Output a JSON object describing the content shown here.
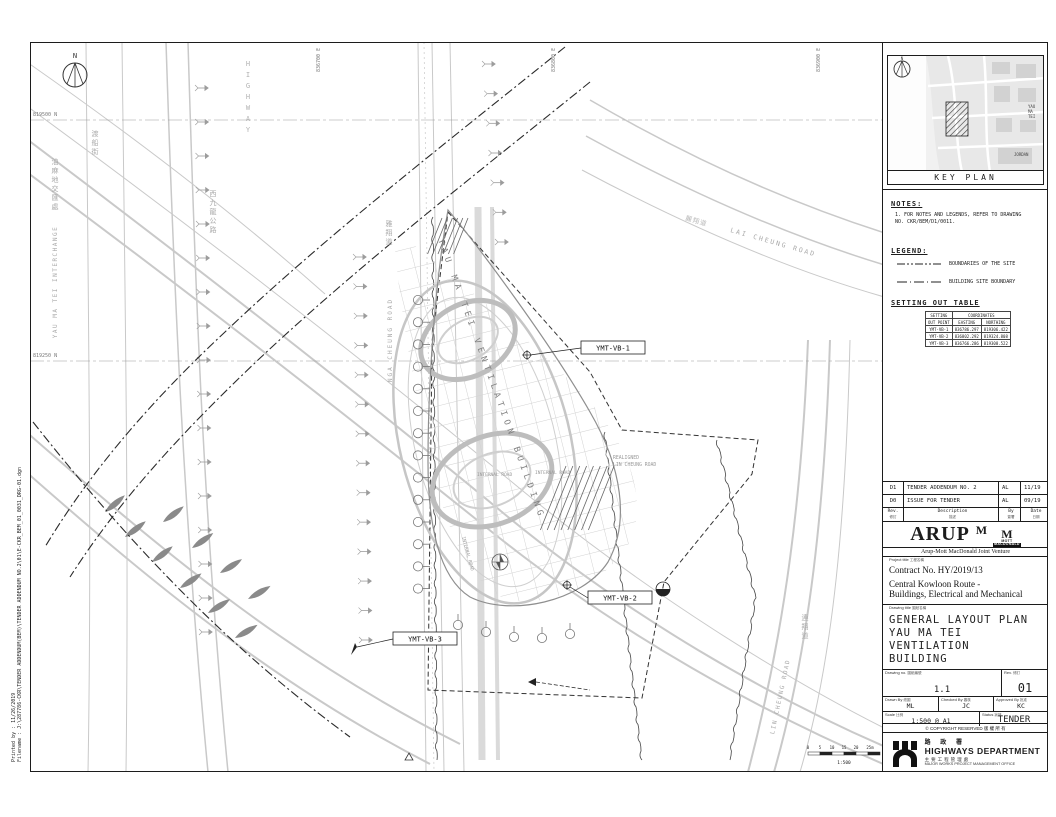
{
  "margin": {
    "printed_by": "Printed by : 11/26/2019",
    "filename": "Filename : J:\\287786-CKR\\TENDER ADDENDUM(BEM)\\TENDER ADDENDUM NO.2\\01\\E-CKR_BEM_01_0031_DRG-01.dgn"
  },
  "plan": {
    "north": "N",
    "grid": {
      "northing1": "819500 N",
      "northing2": "819250 N",
      "easting1": "836700 E",
      "easting2": "836800 E",
      "easting3": "836900 E"
    },
    "roads": {
      "interchange_en": "YAU MA TEI INTERCHANGE",
      "interchange_zh": "油麻地交匯處",
      "highway_en": "HIGHWAY",
      "ferry_street_zh": "渡船街",
      "west_kowloon_highway_zh": "西九龍公路",
      "nga_cheung_en": "NGA CHEUNG ROAD",
      "nga_cheung_zh": "雅翔道",
      "lai_cheung_en": "LAI CHEUNG ROAD",
      "lai_cheung_zh": "麗翔道",
      "lin_cheung_en": "LIN CHEUNG ROAD",
      "lin_cheung_zh": "連翔道",
      "realigned_line1": "REALIGNED",
      "realigned_line2": "LIN CHEUNG ROAD"
    },
    "building": {
      "label": "YAU MA TEI VENTILATION BUILDING",
      "internal_road": "INTERNAL ROAD"
    },
    "setting_out_points": {
      "p1": "YMT-VB-1",
      "p2": "YMT-VB-2",
      "p3": "YMT-VB-3"
    },
    "scalebar": {
      "ticks": [
        "0",
        "5",
        "10",
        "15",
        "20",
        "25m"
      ],
      "ratio": "1:500"
    }
  },
  "titleblock": {
    "keyplan": {
      "caption": "KEY PLAN",
      "north": "N",
      "ymt1": "YAU",
      "ymt2": "MA",
      "ymt3": "TEI",
      "jordan": "JORDAN"
    },
    "notes": {
      "heading": "NOTES:",
      "item": "1. FOR NOTES AND LEGENDS, REFER TO DRAWING NO. CKR/BEM/D1/0011."
    },
    "legend": {
      "heading": "LEGEND:",
      "boundary_site": "BOUNDARIES OF THE SITE",
      "building_site": "BUILDING SITE BOUNDARY"
    },
    "setting_out": {
      "heading": "SETTING OUT TABLE",
      "col_point1": "SETTING",
      "col_point2": "OUT POINT",
      "col_coords": "COORDINATES",
      "col_easting": "EASTING",
      "col_northing": "NORTHING",
      "rows": [
        [
          "YMT-VB-1",
          "836786.297",
          "819306.422"
        ],
        [
          "YMT-VB-2",
          "836802.292",
          "819324.808"
        ],
        [
          "YMT-VB-3",
          "836766.286",
          "819308.522"
        ]
      ]
    },
    "revisions": {
      "rows": [
        {
          "rev": "D1",
          "description": "TENDER ADDENDUM NO. 2",
          "by": "AL",
          "date": "11/19"
        },
        {
          "rev": "D0",
          "description": "ISSUE FOR TENDER",
          "by": "AL",
          "date": "09/19"
        }
      ],
      "header": {
        "rev_en": "Rev.",
        "rev_zh": "修訂",
        "desc_en": "Description",
        "desc_zh": "描述",
        "by_en": "By",
        "by_zh": "簽署",
        "date_en": "Date",
        "date_zh": "日期"
      }
    },
    "firm": {
      "arup": "ARUP",
      "m1": "M",
      "m2": "M",
      "mott": "MOTT",
      "macdonald": "MACDONALD",
      "jv": "Arup-Mott MacDonald Joint Venture"
    },
    "project": {
      "label_en": "Project title",
      "label_zh": "工程名稱",
      "contract": "Contract No. HY/2019/13",
      "title_line1": "Central Kowloon Route -",
      "title_line2": "Buildings, Electrical and Mechanical"
    },
    "drawing": {
      "label_en": "Drawing title",
      "label_zh": "圖紙名稱",
      "line1": "GENERAL LAYOUT PLAN",
      "line2": "YAU MA TEI VENTILATION",
      "line3": "BUILDING"
    },
    "numbers": {
      "drawing_no_en": "Drawing no.",
      "drawing_no_zh": "圖紙編號",
      "drawing_no": "1.1",
      "rev_en": "Rev.",
      "rev_zh": "修訂",
      "rev": "01",
      "drawn_en": "Drawn By",
      "drawn_zh": "繪圖",
      "drawn": "ML",
      "checked_en": "Checked By",
      "checked_zh": "審核",
      "checked": "JC",
      "approved_en": "Approved By",
      "approved_zh": "批准",
      "approved": "KC",
      "scale_en": "Scale",
      "scale_zh": "比例",
      "scale": "1:500 @ A1",
      "status_en": "Status",
      "status_zh": "狀態",
      "status": "TENDER",
      "copyright": "© COPYRIGHT RESERVED  版 權 所 有"
    },
    "department": {
      "name_zh": "路 政 署",
      "name_en": "HIGHWAYS DEPARTMENT",
      "office_zh": "主要工程管理處",
      "office_en": "MAJOR WORKS PROJECT MANAGEMENT OFFICE"
    }
  },
  "colors": {
    "line": "#1c1c1c",
    "road_gray": "#c9c9c9",
    "text_gray": "#a9a9a9",
    "building_gray": "#8f8f8f"
  }
}
